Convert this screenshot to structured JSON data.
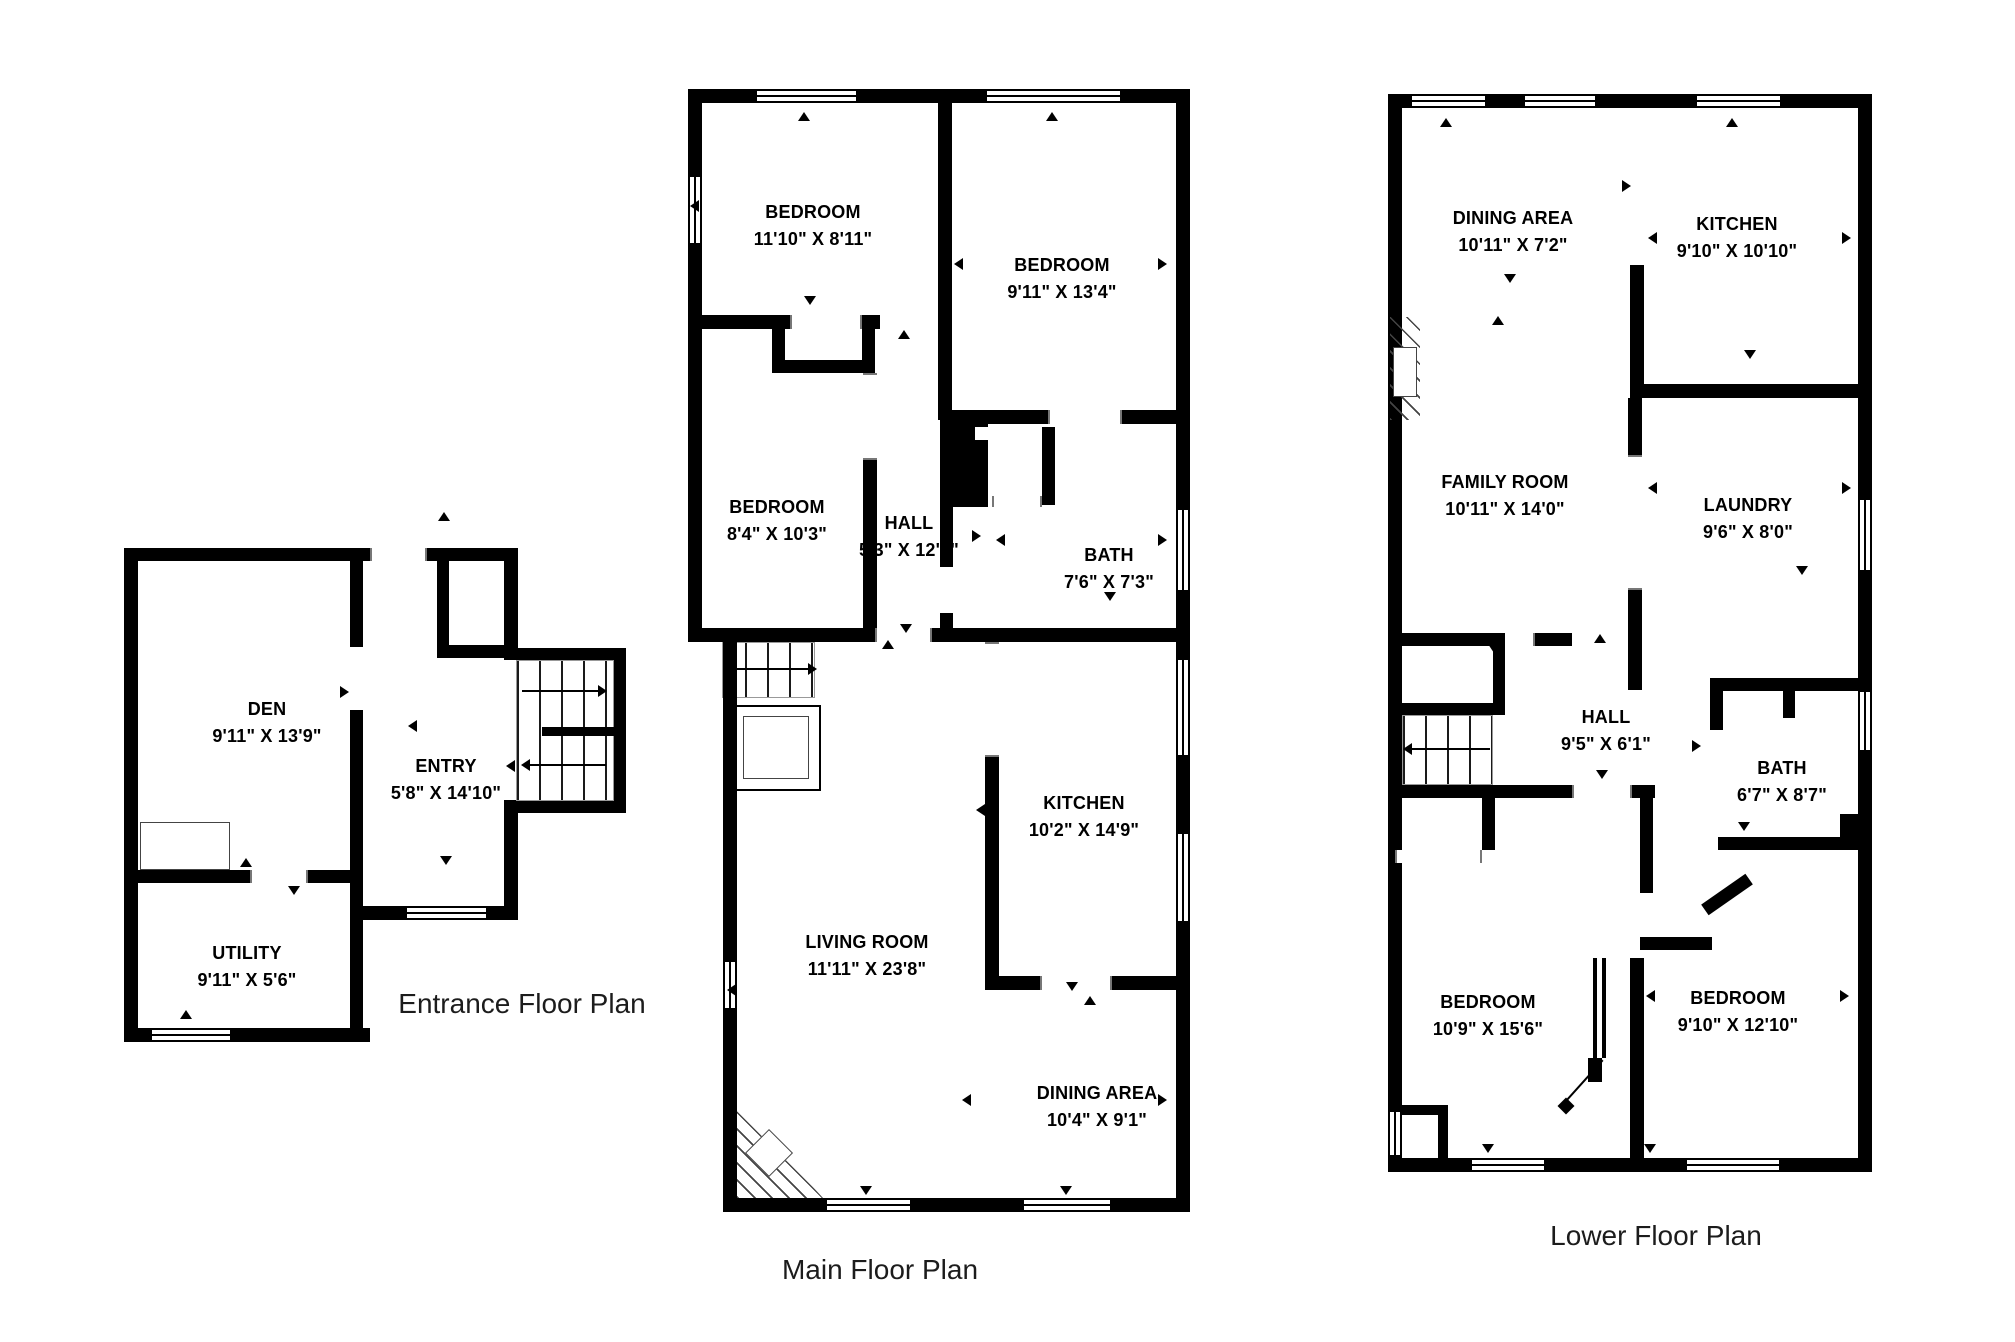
{
  "plans": {
    "entrance": {
      "caption": "Entrance Floor Plan",
      "rooms": {
        "den": {
          "name": "DEN",
          "dims": "9'11\" X 13'9\""
        },
        "entry": {
          "name": "ENTRY",
          "dims": "5'8\" X 14'10\""
        },
        "utility": {
          "name": "UTILITY",
          "dims": "9'11\" X 5'6\""
        }
      }
    },
    "main": {
      "caption": "Main Floor Plan",
      "rooms": {
        "bedroom_top_left": {
          "name": "BEDROOM",
          "dims": "11'10\" X 8'11\""
        },
        "bedroom_top_right": {
          "name": "BEDROOM",
          "dims": "9'11\" X 13'4\""
        },
        "bedroom_mid": {
          "name": "BEDROOM",
          "dims": "8'4\" X 10'3\""
        },
        "hall": {
          "name": "HALL",
          "dims": "5'3\" X 12'9\""
        },
        "bath": {
          "name": "BATH",
          "dims": "7'6\" X 7'3\""
        },
        "kitchen": {
          "name": "KITCHEN",
          "dims": "10'2\" X 14'9\""
        },
        "living_room": {
          "name": "LIVING ROOM",
          "dims": "11'11\" X 23'8\""
        },
        "dining_area": {
          "name": "DINING AREA",
          "dims": "10'4\" X 9'1\""
        }
      }
    },
    "lower": {
      "caption": "Lower Floor Plan",
      "rooms": {
        "dining_area": {
          "name": "DINING AREA",
          "dims": "10'11\" X 7'2\""
        },
        "kitchen": {
          "name": "KITCHEN",
          "dims": "9'10\" X 10'10\""
        },
        "family_room": {
          "name": "FAMILY ROOM",
          "dims": "10'11\" X 14'0\""
        },
        "laundry": {
          "name": "LAUNDRY",
          "dims": "9'6\" X 8'0\""
        },
        "hall": {
          "name": "HALL",
          "dims": "9'5\" X 6'1\""
        },
        "bath": {
          "name": "BATH",
          "dims": "6'7\" X 8'7\""
        },
        "bedroom_left": {
          "name": "BEDROOM",
          "dims": "10'9\" X 15'6\""
        },
        "bedroom_right": {
          "name": "BEDROOM",
          "dims": "9'10\" X 12'10\""
        }
      }
    }
  },
  "colors": {
    "wall": "#000000",
    "background": "#ffffff",
    "marker": "#000000"
  }
}
